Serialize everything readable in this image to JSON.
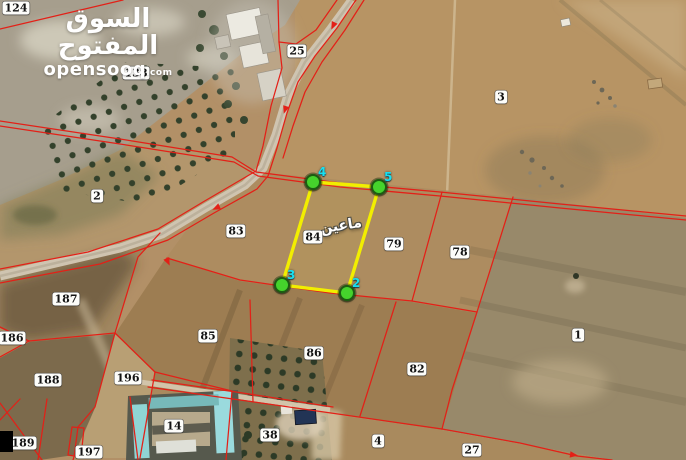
{
  "watermark": {
    "brand_arabic": "السوق المفتوح",
    "brand_domain_main": "opensooq",
    "brand_domain_tld": ".com"
  },
  "map": {
    "colors": {
      "boundary_red": "#e32017",
      "plot_yellow": "#f2ee00",
      "marker_green": "#45d32c",
      "marker_label_cyan": "#17dff0"
    },
    "parcel_labels": [
      {
        "text": "124",
        "x": 16,
        "y": 8
      },
      {
        "text": "138",
        "x": 136,
        "y": 73
      },
      {
        "text": "25",
        "x": 297,
        "y": 51
      },
      {
        "text": "3",
        "x": 501,
        "y": 97
      },
      {
        "text": "2",
        "x": 97,
        "y": 196
      },
      {
        "text": "83",
        "x": 236,
        "y": 231
      },
      {
        "text": "84",
        "x": 313,
        "y": 237
      },
      {
        "text": "79",
        "x": 394,
        "y": 244
      },
      {
        "text": "78",
        "x": 460,
        "y": 252
      },
      {
        "text": "187",
        "x": 66,
        "y": 299
      },
      {
        "text": "186",
        "x": 12,
        "y": 338
      },
      {
        "text": "85",
        "x": 208,
        "y": 336
      },
      {
        "text": "1",
        "x": 578,
        "y": 335
      },
      {
        "text": "188",
        "x": 48,
        "y": 380
      },
      {
        "text": "196",
        "x": 128,
        "y": 378
      },
      {
        "text": "86",
        "x": 314,
        "y": 353
      },
      {
        "text": "82",
        "x": 417,
        "y": 369
      },
      {
        "text": "14",
        "x": 174,
        "y": 426
      },
      {
        "text": "189",
        "x": 23,
        "y": 443
      },
      {
        "text": "197",
        "x": 89,
        "y": 452
      },
      {
        "text": "38",
        "x": 270,
        "y": 435
      },
      {
        "text": "4",
        "x": 378,
        "y": 441
      },
      {
        "text": "27",
        "x": 472,
        "y": 450
      }
    ],
    "highlight": {
      "name_arabic": "ماعين",
      "parcel_number": "84",
      "polygon": [
        [
          313,
          182
        ],
        [
          379,
          187
        ],
        [
          347,
          293
        ],
        [
          282,
          285
        ]
      ],
      "markers": [
        {
          "label": "4",
          "x": 313,
          "y": 182
        },
        {
          "label": "5",
          "x": 379,
          "y": 187
        },
        {
          "label": "3",
          "x": 282,
          "y": 285
        },
        {
          "label": "2",
          "x": 347,
          "y": 293
        }
      ]
    }
  }
}
